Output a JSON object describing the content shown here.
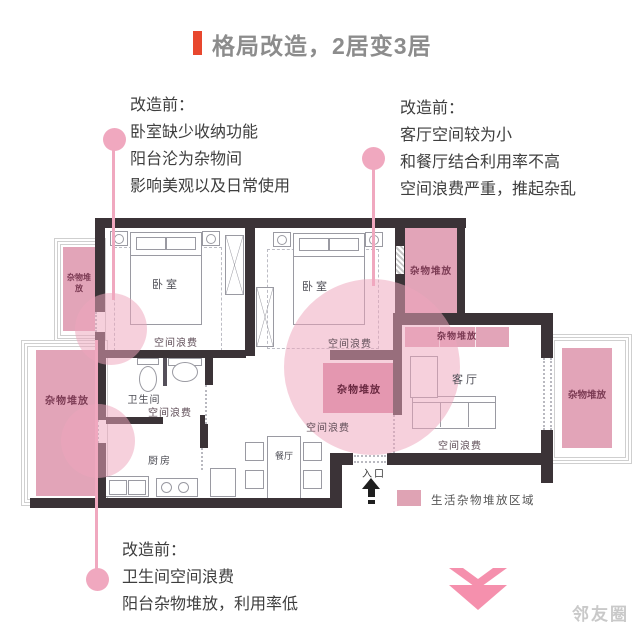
{
  "title": "格局改造，2居变3居",
  "callouts": {
    "top_left": {
      "heading": "改造前：",
      "lines": [
        "卧室缺少收纳功能",
        "阳台沦为杂物间",
        "影响美观以及日常使用"
      ]
    },
    "top_right": {
      "heading": "改造前：",
      "lines": [
        "客厅空间较为小",
        "和餐厅结合利用率不高",
        "空间浪费严重，推起杂乱"
      ]
    },
    "bottom": {
      "heading": "改造前：",
      "lines": [
        "卫生间空间浪费",
        "阳台杂物堆放，利用率低"
      ]
    }
  },
  "floorplan": {
    "rooms": {
      "bedroom": "卧室",
      "bathroom": "卫生间",
      "kitchen": "厨房",
      "dining": "餐厅",
      "living": "客厅"
    },
    "entrance_label": "入口",
    "waste_label": "空间浪费",
    "clutter_label": "杂物堆放"
  },
  "legend": {
    "label": "生活杂物堆放区域",
    "swatch_color": "#dfa3b4"
  },
  "watermark": "邻友圈",
  "colors": {
    "accent_red": "#e8472e",
    "title_gray": "#8c8c8c",
    "wall": "#3b3337",
    "pink_zone": "#e2a4b8",
    "pink_zone_dark": "#d989a4",
    "connector_pink": "#f0a8bf",
    "arrow_pink": "#f590ad"
  }
}
